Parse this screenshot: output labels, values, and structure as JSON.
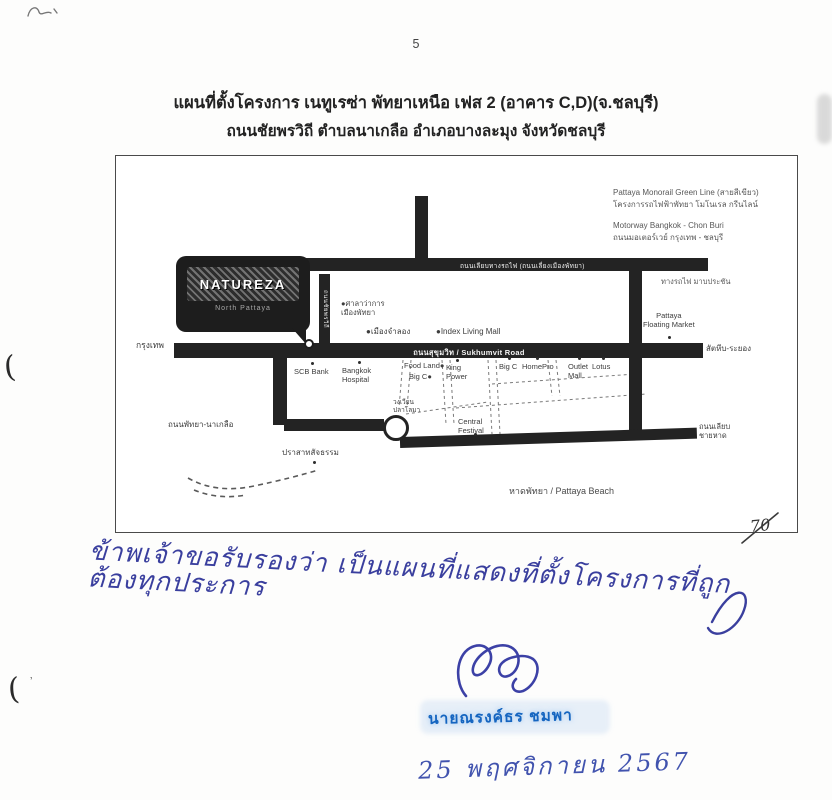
{
  "document": {
    "page_number": "5",
    "title_line1": "แผนที่ตั้งโครงการ เนทูเรซ่า พัทยาเหนือ เฟส 2 (อาคาร C,D)(จ.ชลบุรี)",
    "title_line2": "ถนนชัยพรวิถี ตำบลนาเกลือ อำเภอบางละมุง จังหวัดชลบุรี"
  },
  "map": {
    "legend": {
      "monorail_en": "Pattaya Monorail Green Line (สายสีเขียว)",
      "monorail_th": "โครงการรถไฟฟ้าพัทยา โมโนเรล กรีนไลน์",
      "motorway_en": "Motorway Bangkok - Chon Buri",
      "motorway_th": "ถนนมอเตอร์เวย์ กรุงเทพ - ชลบุรี"
    },
    "project": {
      "name": "NATUREZA",
      "subtitle": "North Pattaya"
    },
    "roads": {
      "railway": "ถนนเลียบทางรถไฟ (ถนนเลี่ยงเมืองพัทยา)",
      "railway_dest": "ทางรถไฟ มาบประชัน",
      "sukhumvit": "ถนนสุขุมวิท / Sukhumvit Road",
      "chaiyaphon_withi": "ถนนชัยพรวิถี",
      "bangkok": "กรุงเทพ",
      "sattahip_rayong": "สัตหีบ-ระยอง",
      "pattaya_naklua": "ถนนพัทยา-นาเกลือ",
      "beach_road": "ถนนเลียบ\nชายหาด",
      "pattaya_beach": "หาดพัทยา / Pattaya Beach"
    },
    "landmarks": {
      "city_hall": "●ศาลาว่าการ\nเมืองพัทยา",
      "mini_siam": "●เมืองจำลอง",
      "index_living_mall": "●Index Living Mall",
      "scb_bank": "SCB Bank",
      "bangkok_hospital": "Bangkok\nHospital",
      "food_land": "Food Land●",
      "big_c_north": "Big C●",
      "king_power": "King\nPower",
      "big_c": "Big C",
      "homepro": "HomePro",
      "outlet_mall": "Outlet\nMall",
      "lotus": "Lotus",
      "dolphin_circle": "วงเวียน\nปลาโลมา",
      "central_festival": "Central\nFestival",
      "sanctuary_of_truth": "ปราสาทสัจธรรม",
      "floating_market": "Pattaya\nFloating Market"
    }
  },
  "annotations": {
    "handwritten_note": "ข้าพเจ้าขอรับรองว่า เป็นแผนที่แสดงที่ตั้งโครงการที่ถูกต้องทุกประการ",
    "stamp_name": "นายณรงค์ธร ชมพา",
    "handwritten_date": "25 พฤศจิกายน 2567",
    "page_ref": "70",
    "margin_mark_top": "(",
    "margin_mark_bottom": "(",
    "colors": {
      "handwriting_blue": "#3a3f9e",
      "stamp_blue": "#1565c0",
      "date_blue": "#4153ae"
    }
  }
}
